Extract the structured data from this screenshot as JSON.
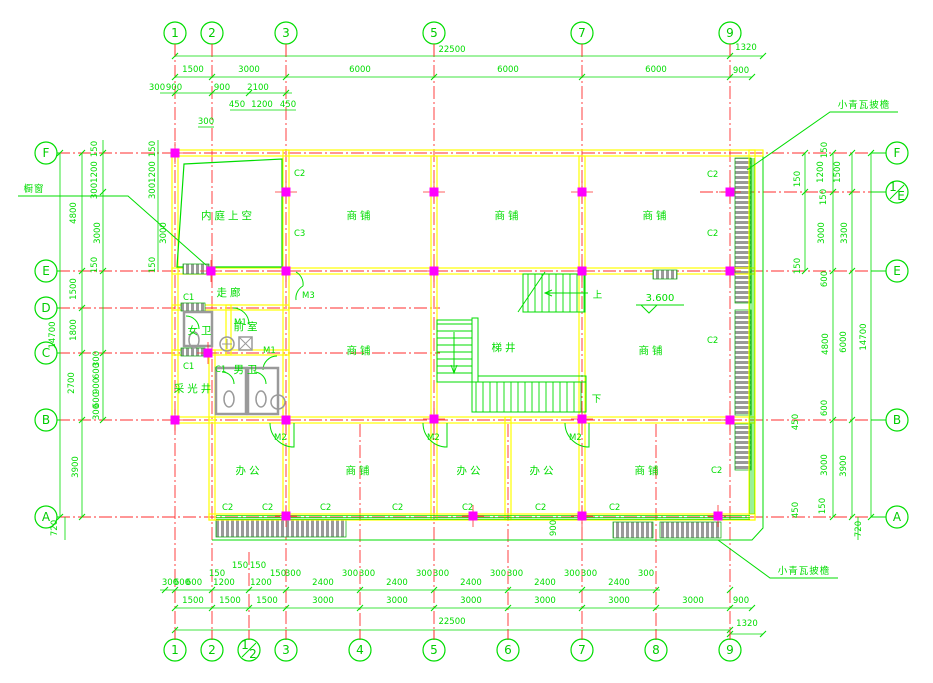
{
  "drawing": {
    "colors": {
      "green": "#00dd00",
      "red": "#ff2d2d",
      "yellow": "#ffff00",
      "magenta": "#ff00ff",
      "gray": "#9a9a9a",
      "bg": "#ffffff"
    },
    "axes": {
      "top": [
        {
          "label": "1",
          "x": 175
        },
        {
          "label": "2",
          "x": 212
        },
        {
          "label": "3",
          "x": 286
        },
        {
          "label": "5",
          "x": 434
        },
        {
          "label": "7",
          "x": 582
        },
        {
          "label": "9",
          "x": 730
        }
      ],
      "bottom": [
        {
          "label": "1",
          "x": 175
        },
        {
          "label": "2",
          "x": 212
        },
        {
          "label": "1/2",
          "x": 249
        },
        {
          "label": "3",
          "x": 286
        },
        {
          "label": "4",
          "x": 360
        },
        {
          "label": "5",
          "x": 434
        },
        {
          "label": "6",
          "x": 508
        },
        {
          "label": "7",
          "x": 582
        },
        {
          "label": "8",
          "x": 656
        },
        {
          "label": "9",
          "x": 730
        }
      ],
      "left": [
        {
          "label": "F",
          "y": 153
        },
        {
          "label": "E",
          "y": 271
        },
        {
          "label": "D",
          "y": 308
        },
        {
          "label": "C",
          "y": 353
        },
        {
          "label": "B",
          "y": 420
        },
        {
          "label": "A",
          "y": 517
        }
      ],
      "right": [
        {
          "label": "F",
          "y": 153
        },
        {
          "label": "1/E",
          "y": 192
        },
        {
          "label": "E",
          "y": 271
        },
        {
          "label": "B",
          "y": 420
        },
        {
          "label": "A",
          "y": 517
        }
      ]
    },
    "dim_texts_h": [
      {
        "t": "22500",
        "x": 452,
        "y": 52
      },
      {
        "t": "1320",
        "x": 746,
        "y": 50
      },
      {
        "t": "1500",
        "x": 193,
        "y": 72
      },
      {
        "t": "3000",
        "x": 249,
        "y": 72
      },
      {
        "t": "6000",
        "x": 360,
        "y": 72
      },
      {
        "t": "6000",
        "x": 508,
        "y": 72
      },
      {
        "t": "6000",
        "x": 656,
        "y": 72
      },
      {
        "t": "900",
        "x": 741,
        "y": 73
      },
      {
        "t": "300",
        "x": 157,
        "y": 90
      },
      {
        "t": "900",
        "x": 174,
        "y": 90
      },
      {
        "t": "900",
        "x": 222,
        "y": 90
      },
      {
        "t": "2100",
        "x": 258,
        "y": 90
      },
      {
        "t": "450",
        "x": 237,
        "y": 107
      },
      {
        "t": "1200",
        "x": 262,
        "y": 107
      },
      {
        "t": "450",
        "x": 288,
        "y": 107
      },
      {
        "t": "300",
        "x": 206,
        "y": 124
      },
      {
        "t": "150",
        "x": 240,
        "y": 568
      },
      {
        "t": "150",
        "x": 258,
        "y": 568
      },
      {
        "t": "150",
        "x": 217,
        "y": 576
      },
      {
        "t": "150",
        "x": 278,
        "y": 576
      },
      {
        "t": "300",
        "x": 293,
        "y": 576
      },
      {
        "t": "300",
        "x": 350,
        "y": 576
      },
      {
        "t": "300",
        "x": 367,
        "y": 576
      },
      {
        "t": "300",
        "x": 424,
        "y": 576
      },
      {
        "t": "300",
        "x": 441,
        "y": 576
      },
      {
        "t": "300",
        "x": 498,
        "y": 576
      },
      {
        "t": "300",
        "x": 515,
        "y": 576
      },
      {
        "t": "300",
        "x": 572,
        "y": 576
      },
      {
        "t": "300",
        "x": 589,
        "y": 576
      },
      {
        "t": "300",
        "x": 646,
        "y": 576
      },
      {
        "t": "300",
        "x": 170,
        "y": 585
      },
      {
        "t": "600",
        "x": 182,
        "y": 585
      },
      {
        "t": "600",
        "x": 194,
        "y": 585
      },
      {
        "t": "1200",
        "x": 224,
        "y": 585
      },
      {
        "t": "1200",
        "x": 261,
        "y": 585
      },
      {
        "t": "2400",
        "x": 323,
        "y": 585
      },
      {
        "t": "2400",
        "x": 397,
        "y": 585
      },
      {
        "t": "2400",
        "x": 471,
        "y": 585
      },
      {
        "t": "2400",
        "x": 545,
        "y": 585
      },
      {
        "t": "2400",
        "x": 619,
        "y": 585
      },
      {
        "t": "1500",
        "x": 193,
        "y": 603
      },
      {
        "t": "1500",
        "x": 230,
        "y": 603
      },
      {
        "t": "1500",
        "x": 267,
        "y": 603
      },
      {
        "t": "3000",
        "x": 323,
        "y": 603
      },
      {
        "t": "3000",
        "x": 397,
        "y": 603
      },
      {
        "t": "3000",
        "x": 471,
        "y": 603
      },
      {
        "t": "3000",
        "x": 545,
        "y": 603
      },
      {
        "t": "3000",
        "x": 619,
        "y": 603
      },
      {
        "t": "3000",
        "x": 693,
        "y": 603
      },
      {
        "t": "900",
        "x": 741,
        "y": 603
      },
      {
        "t": "22500",
        "x": 452,
        "y": 624
      },
      {
        "t": "1320",
        "x": 747,
        "y": 626
      }
    ],
    "dim_texts_v": [
      {
        "t": "14700",
        "x": 55,
        "y": 335
      },
      {
        "t": "4800",
        "x": 76,
        "y": 213
      },
      {
        "t": "1500",
        "x": 76,
        "y": 289
      },
      {
        "t": "1800",
        "x": 76,
        "y": 330
      },
      {
        "t": "2700",
        "x": 74,
        "y": 383
      },
      {
        "t": "3900",
        "x": 78,
        "y": 467
      },
      {
        "t": "720",
        "x": 57,
        "y": 528
      },
      {
        "t": "150",
        "x": 97,
        "y": 149
      },
      {
        "t": "1200",
        "x": 97,
        "y": 172
      },
      {
        "t": "300",
        "x": 97,
        "y": 191
      },
      {
        "t": "3000",
        "x": 100,
        "y": 233
      },
      {
        "t": "150",
        "x": 97,
        "y": 265
      },
      {
        "t": "300",
        "x": 99,
        "y": 359
      },
      {
        "t": "600",
        "x": 99,
        "y": 371
      },
      {
        "t": "900",
        "x": 99,
        "y": 386
      },
      {
        "t": "600",
        "x": 99,
        "y": 400
      },
      {
        "t": "300",
        "x": 99,
        "y": 412
      },
      {
        "t": "150",
        "x": 155,
        "y": 149
      },
      {
        "t": "1200",
        "x": 155,
        "y": 172
      },
      {
        "t": "300",
        "x": 155,
        "y": 191
      },
      {
        "t": "3000",
        "x": 166,
        "y": 233
      },
      {
        "t": "150",
        "x": 155,
        "y": 265
      },
      {
        "t": "150",
        "x": 827,
        "y": 150
      },
      {
        "t": "1200",
        "x": 823,
        "y": 172
      },
      {
        "t": "1500",
        "x": 840,
        "y": 172
      },
      {
        "t": "150",
        "x": 800,
        "y": 179
      },
      {
        "t": "150",
        "x": 826,
        "y": 197
      },
      {
        "t": "3000",
        "x": 824,
        "y": 233
      },
      {
        "t": "3300",
        "x": 847,
        "y": 233
      },
      {
        "t": "150",
        "x": 800,
        "y": 266
      },
      {
        "t": "600",
        "x": 827,
        "y": 279
      },
      {
        "t": "4800",
        "x": 828,
        "y": 344
      },
      {
        "t": "6000",
        "x": 846,
        "y": 342
      },
      {
        "t": "14700",
        "x": 866,
        "y": 337
      },
      {
        "t": "600",
        "x": 827,
        "y": 408
      },
      {
        "t": "450",
        "x": 798,
        "y": 422
      },
      {
        "t": "3000",
        "x": 827,
        "y": 465
      },
      {
        "t": "3900",
        "x": 846,
        "y": 466
      },
      {
        "t": "150",
        "x": 825,
        "y": 506
      },
      {
        "t": "450",
        "x": 798,
        "y": 510
      },
      {
        "t": "720",
        "x": 861,
        "y": 529
      },
      {
        "t": "900",
        "x": 556,
        "y": 528
      }
    ],
    "rooms": [
      {
        "t": "内庭上空",
        "x": 228,
        "y": 219
      },
      {
        "t": "商铺",
        "x": 360,
        "y": 219
      },
      {
        "t": "商铺",
        "x": 508,
        "y": 219
      },
      {
        "t": "商铺",
        "x": 656,
        "y": 219
      },
      {
        "t": "走廊",
        "x": 230,
        "y": 296
      },
      {
        "t": "女卫",
        "x": 201,
        "y": 334
      },
      {
        "t": "前室",
        "x": 247,
        "y": 330
      },
      {
        "t": "男卫",
        "x": 247,
        "y": 373
      },
      {
        "t": "采光井",
        "x": 194,
        "y": 392
      },
      {
        "t": "商铺",
        "x": 360,
        "y": 354
      },
      {
        "t": "梯井",
        "x": 505,
        "y": 351
      },
      {
        "t": "商铺",
        "x": 652,
        "y": 354
      },
      {
        "t": "办公",
        "x": 249,
        "y": 474
      },
      {
        "t": "商铺",
        "x": 359,
        "y": 474
      },
      {
        "t": "办公",
        "x": 470,
        "y": 474
      },
      {
        "t": "办公",
        "x": 543,
        "y": 474
      },
      {
        "t": "商铺",
        "x": 648,
        "y": 474
      }
    ],
    "tags": [
      {
        "t": "C2",
        "x": 294,
        "y": 176
      },
      {
        "t": "C3",
        "x": 294,
        "y": 236
      },
      {
        "t": "C1",
        "x": 183,
        "y": 300
      },
      {
        "t": "M3",
        "x": 302,
        "y": 298
      },
      {
        "t": "M1",
        "x": 234,
        "y": 325
      },
      {
        "t": "M1",
        "x": 263,
        "y": 353
      },
      {
        "t": "C1",
        "x": 183,
        "y": 369
      },
      {
        "t": "C1",
        "x": 215,
        "y": 372
      },
      {
        "t": "M2",
        "x": 274,
        "y": 440
      },
      {
        "t": "M2",
        "x": 427,
        "y": 440
      },
      {
        "t": "M2",
        "x": 569,
        "y": 440
      },
      {
        "t": "C2",
        "x": 222,
        "y": 510
      },
      {
        "t": "C2",
        "x": 262,
        "y": 510
      },
      {
        "t": "C2",
        "x": 320,
        "y": 510
      },
      {
        "t": "C2",
        "x": 392,
        "y": 510
      },
      {
        "t": "C2",
        "x": 462,
        "y": 510
      },
      {
        "t": "C2",
        "x": 535,
        "y": 510
      },
      {
        "t": "C2",
        "x": 609,
        "y": 510
      },
      {
        "t": "C2",
        "x": 707,
        "y": 177
      },
      {
        "t": "C2",
        "x": 707,
        "y": 236
      },
      {
        "t": "C2",
        "x": 707,
        "y": 343
      },
      {
        "t": "C2",
        "x": 711,
        "y": 473
      }
    ],
    "annotations": {
      "eave_top": "小青瓦披檐",
      "eave_bottom": "小青瓦披檐",
      "shop_window": "橱窗",
      "level": "3.600",
      "up": "上",
      "down": "下"
    },
    "columns": [
      [
        175,
        153
      ],
      [
        286,
        192
      ],
      [
        434,
        192
      ],
      [
        582,
        192
      ],
      [
        730,
        192
      ],
      [
        211,
        271
      ],
      [
        286,
        271
      ],
      [
        434,
        271
      ],
      [
        582,
        271
      ],
      [
        730,
        271
      ],
      [
        208,
        353
      ],
      [
        175,
        420
      ],
      [
        286,
        420
      ],
      [
        434,
        419
      ],
      [
        582,
        419
      ],
      [
        730,
        420
      ],
      [
        286,
        516
      ],
      [
        473,
        516
      ],
      [
        582,
        516
      ],
      [
        718,
        516
      ]
    ],
    "grid_v": [
      {
        "x": 175,
        "y1": 44,
        "y2": 640
      },
      {
        "x": 212,
        "y1": 44,
        "y2": 640
      },
      {
        "x": 286,
        "y1": 44,
        "y2": 640
      },
      {
        "x": 434,
        "y1": 44,
        "y2": 640
      },
      {
        "x": 582,
        "y1": 44,
        "y2": 640
      },
      {
        "x": 730,
        "y1": 44,
        "y2": 640
      },
      {
        "x": 249,
        "y1": 552,
        "y2": 640
      },
      {
        "x": 360,
        "y1": 424,
        "y2": 640
      },
      {
        "x": 508,
        "y1": 424,
        "y2": 640
      },
      {
        "x": 656,
        "y1": 424,
        "y2": 640
      }
    ],
    "grid_h": [
      {
        "y": 153,
        "x1": 57,
        "x2": 886
      },
      {
        "y": 271,
        "x1": 57,
        "x2": 886
      },
      {
        "y": 420,
        "x1": 57,
        "x2": 886
      },
      {
        "y": 517,
        "x1": 57,
        "x2": 886
      },
      {
        "y": 308,
        "x1": 57,
        "x2": 440
      },
      {
        "y": 353,
        "x1": 57,
        "x2": 440
      },
      {
        "y": 192,
        "x1": 700,
        "x2": 886
      }
    ],
    "dim_lines": [
      {
        "x1": 175,
        "y1": 56,
        "x2": 763,
        "y2": 56
      },
      {
        "x1": 175,
        "y1": 77,
        "x2": 752,
        "y2": 77
      },
      {
        "x1": 160,
        "y1": 93,
        "x2": 292,
        "y2": 93
      },
      {
        "x1": 230,
        "y1": 110,
        "x2": 296,
        "y2": 110
      },
      {
        "x1": 198,
        "y1": 127,
        "x2": 214,
        "y2": 127
      },
      {
        "x1": 60,
        "y1": 153,
        "x2": 60,
        "y2": 517
      },
      {
        "x1": 82,
        "y1": 153,
        "x2": 82,
        "y2": 517
      },
      {
        "x1": 103,
        "y1": 140,
        "x2": 103,
        "y2": 420
      },
      {
        "x1": 158,
        "y1": 140,
        "x2": 158,
        "y2": 270
      },
      {
        "x1": 65,
        "y1": 517,
        "x2": 65,
        "y2": 540
      },
      {
        "x1": 805,
        "y1": 153,
        "x2": 805,
        "y2": 271
      },
      {
        "x1": 833,
        "y1": 153,
        "x2": 833,
        "y2": 517
      },
      {
        "x1": 852,
        "y1": 153,
        "x2": 852,
        "y2": 517
      },
      {
        "x1": 871,
        "y1": 153,
        "x2": 871,
        "y2": 517
      },
      {
        "x1": 858,
        "y1": 517,
        "x2": 858,
        "y2": 540
      },
      {
        "x1": 160,
        "y1": 590,
        "x2": 660,
        "y2": 590
      },
      {
        "x1": 175,
        "y1": 608,
        "x2": 752,
        "y2": 608
      },
      {
        "x1": 175,
        "y1": 630,
        "x2": 730,
        "y2": 630
      },
      {
        "x1": 730,
        "y1": 634,
        "x2": 763,
        "y2": 634
      }
    ],
    "ticks_h": [
      {
        "y": 56,
        "xs": [
          175,
          730,
          763
        ]
      },
      {
        "y": 77,
        "xs": [
          175,
          212,
          286,
          434,
          582,
          730,
          752
        ]
      },
      {
        "y": 93,
        "xs": [
          175,
          212,
          249,
          286
        ]
      },
      {
        "y": 590,
        "xs": [
          165,
          175,
          212,
          249,
          286,
          360,
          434,
          508,
          582,
          656,
          730
        ]
      },
      {
        "y": 608,
        "xs": [
          175,
          212,
          249,
          286,
          360,
          434,
          508,
          582,
          656,
          730,
          752
        ]
      },
      {
        "y": 630,
        "xs": [
          175,
          730
        ]
      },
      {
        "y": 634,
        "xs": [
          730,
          763
        ]
      }
    ],
    "ticks_v": [
      {
        "x": 60,
        "ys": [
          153,
          517
        ]
      },
      {
        "x": 82,
        "ys": [
          153,
          271,
          308,
          353,
          420,
          517
        ]
      },
      {
        "x": 103,
        "ys": [
          153,
          192,
          271,
          353,
          420
        ]
      },
      {
        "x": 805,
        "ys": [
          153,
          192,
          271
        ]
      },
      {
        "x": 833,
        "ys": [
          153,
          192,
          271,
          420,
          517
        ]
      },
      {
        "x": 852,
        "ys": [
          153,
          192,
          271,
          420,
          517
        ]
      },
      {
        "x": 871,
        "ys": [
          153,
          517
        ]
      }
    ]
  }
}
